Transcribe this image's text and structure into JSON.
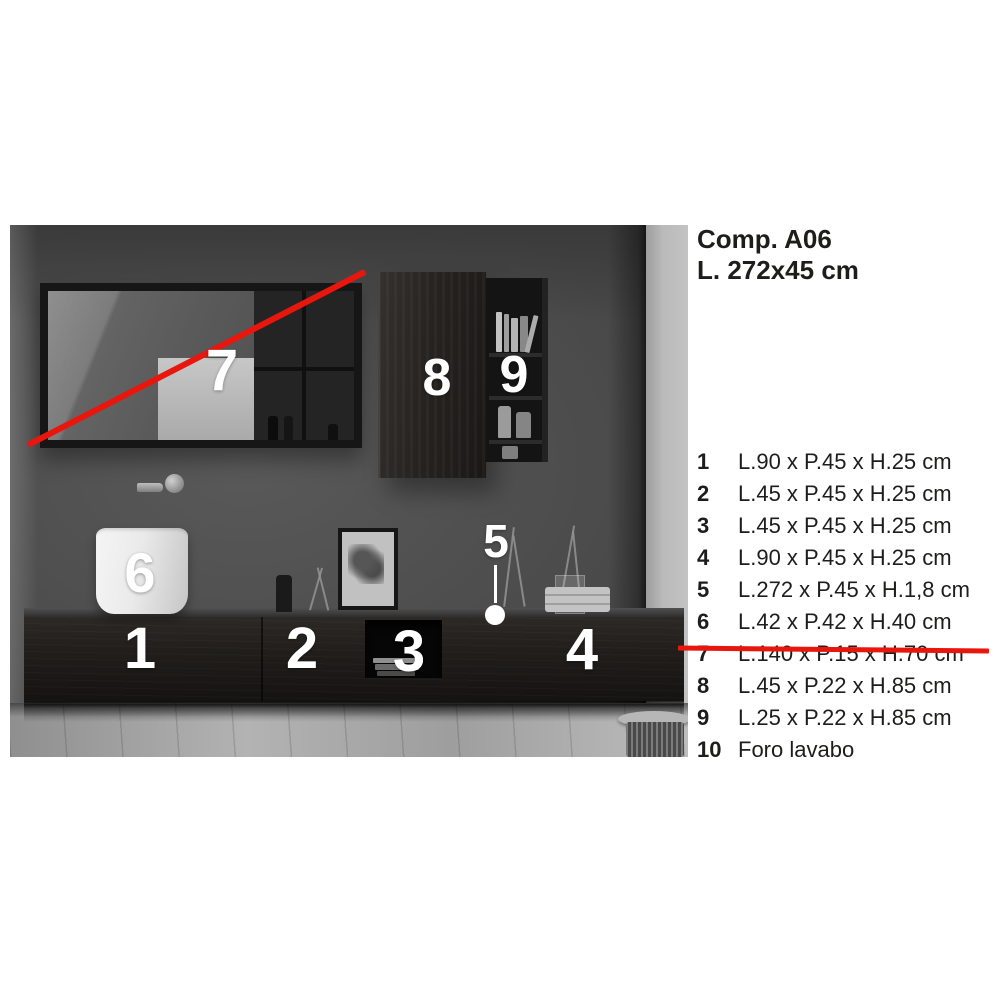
{
  "header": {
    "title": "Comp. A06",
    "size": "L. 272x45 cm"
  },
  "legend": {
    "items": [
      {
        "num": "1",
        "text": "L.90 x P.45 x H.25 cm",
        "struck": false
      },
      {
        "num": "2",
        "text": "L.45 x P.45 x H.25 cm",
        "struck": false
      },
      {
        "num": "3",
        "text": "L.45 x P.45 x H.25 cm",
        "struck": false
      },
      {
        "num": "4",
        "text": "L.90 x P.45 x H.25 cm",
        "struck": false
      },
      {
        "num": "5",
        "text": "L.272 x P.45 x H.1,8 cm",
        "struck": false
      },
      {
        "num": "6",
        "text": "L.42 x P.42 x H.40 cm",
        "struck": false
      },
      {
        "num": "7",
        "text": "L.140 x P.15 x H.70 cm",
        "struck": true
      },
      {
        "num": "8",
        "text": "L.45 x P.22 x H.85 cm",
        "struck": false
      },
      {
        "num": "9",
        "text": "L.25 x P.22 x H.85 cm",
        "struck": false
      },
      {
        "num": "10",
        "text": "Foro lavabo",
        "struck": false
      }
    ]
  },
  "photo": {
    "labels": [
      "1",
      "2",
      "3",
      "4",
      "5",
      "6",
      "7",
      "8",
      "9"
    ]
  },
  "colors": {
    "accent_red": "#e8170e",
    "text": "#1d1d1b"
  }
}
